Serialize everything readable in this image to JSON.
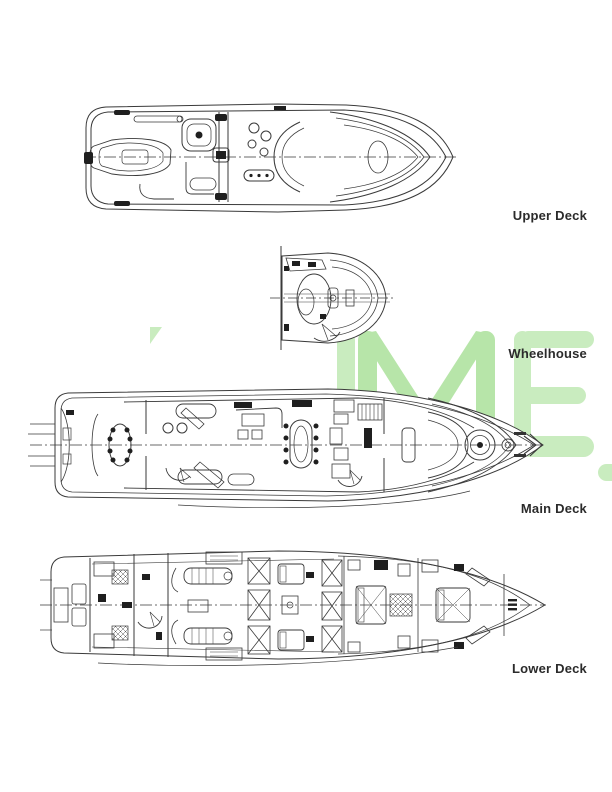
{
  "watermark": {
    "text": "IME",
    "color": "#c9ecbf",
    "accent_color": "#b7e5a9"
  },
  "drawing": {
    "line_color": "#3a3a3a",
    "ink_color": "#1f1f1f",
    "paper_color": "#ffffff",
    "label_color": "#2b2b2b"
  },
  "decks": [
    {
      "id": "upper-deck",
      "label": "Upper Deck"
    },
    {
      "id": "wheelhouse",
      "label": "Wheelhouse"
    },
    {
      "id": "main-deck",
      "label": "Main Deck"
    },
    {
      "id": "lower-deck",
      "label": "Lower Deck"
    }
  ]
}
